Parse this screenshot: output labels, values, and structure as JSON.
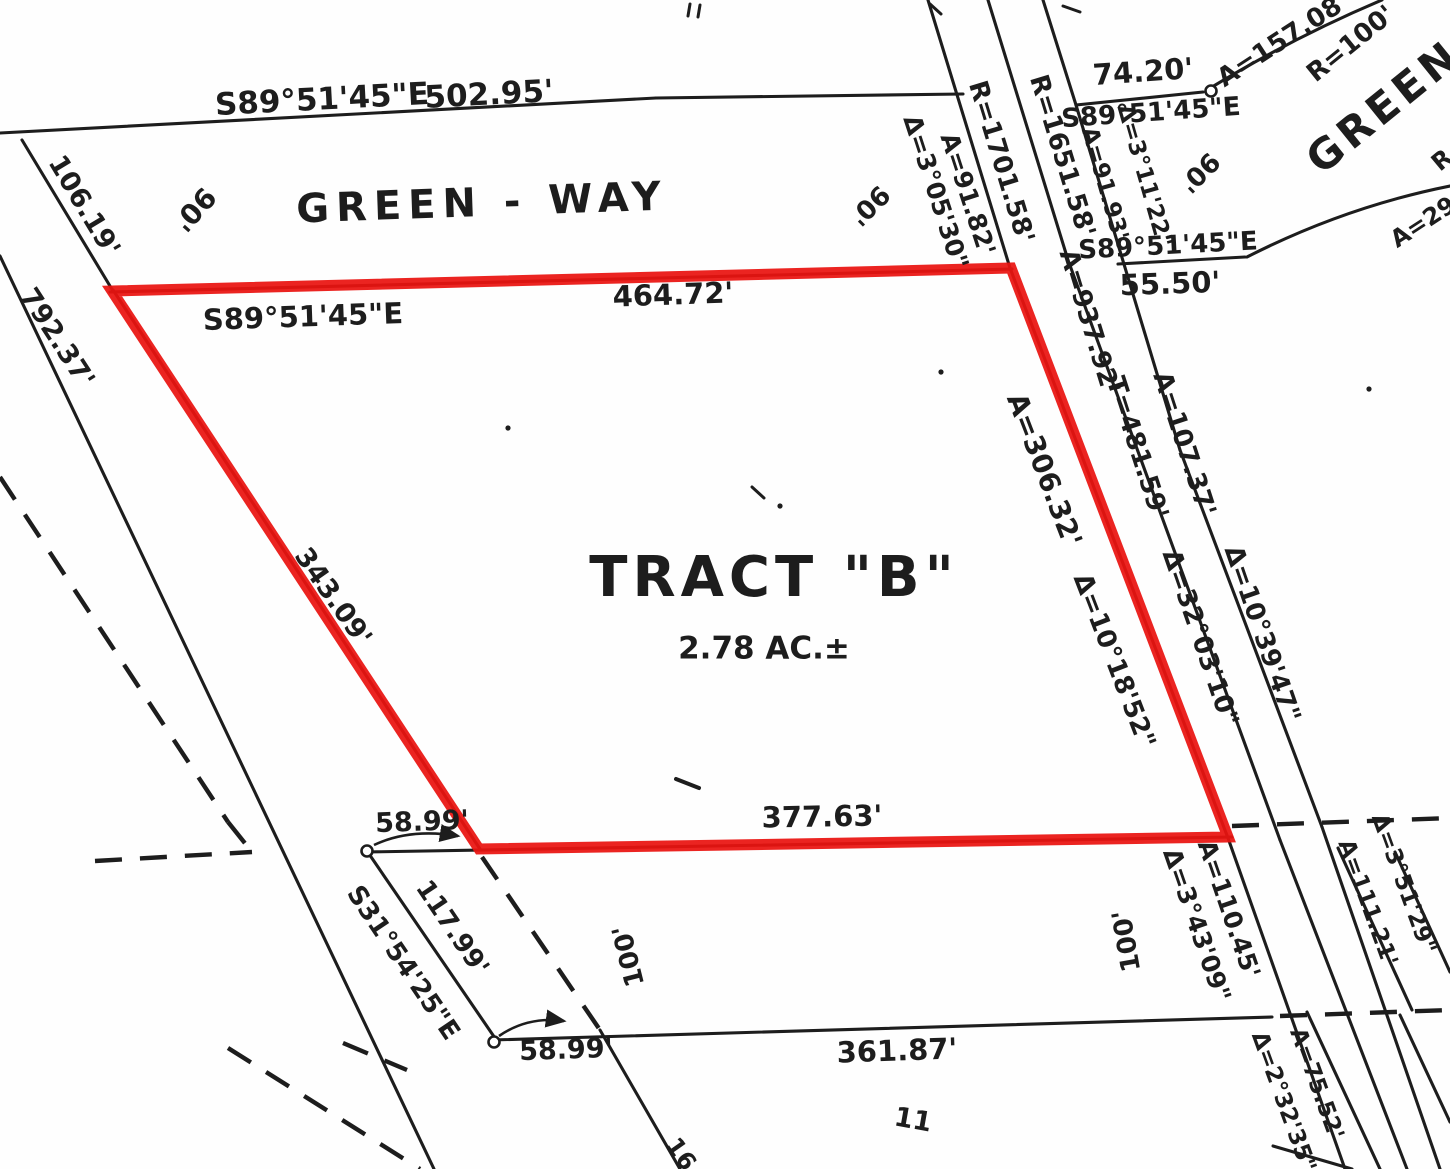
{
  "document": {
    "type": "survey plat map (scanned)",
    "tract_name": "TRACT \"B\"",
    "tract_area": "2.78 AC.±",
    "road_name": "GREEN - WAY"
  },
  "colors": {
    "ink": "#1d1d1d",
    "highlight": "#ea1310",
    "paper": "#fefefe"
  },
  "labels": [
    {
      "id": "bearing-top",
      "t": "S89°51'45\"E",
      "x": 322,
      "y": 100,
      "r": -3,
      "s": 31
    },
    {
      "id": "dist-top",
      "t": "502.95'",
      "x": 489,
      "y": 95,
      "r": -3,
      "s": 31
    },
    {
      "id": "road-name-top",
      "t": "GREEN - WAY",
      "x": 482,
      "y": 203,
      "r": -2,
      "s": 40,
      "ls": 7
    },
    {
      "id": "width-90-a",
      "t": "90'",
      "x": 194,
      "y": 209,
      "r": 132,
      "s": 28
    },
    {
      "id": "dist-106",
      "t": "106.19'",
      "x": 84,
      "y": 206,
      "r": 59,
      "s": 27
    },
    {
      "id": "dist-792",
      "t": "792.37'",
      "x": 57,
      "y": 338,
      "r": 57,
      "s": 27
    },
    {
      "id": "bearing-parcel-top",
      "t": "S89°51'45\"E",
      "x": 303,
      "y": 317,
      "r": -2,
      "s": 29
    },
    {
      "id": "dist-parcel-top",
      "t": "464.72'",
      "x": 673,
      "y": 295,
      "r": -2,
      "s": 29
    },
    {
      "id": "dist-343",
      "t": "343.09'",
      "x": 333,
      "y": 597,
      "r": 55,
      "s": 27
    },
    {
      "id": "tract-name",
      "t": "TRACT \"B\"",
      "x": 774,
      "y": 578,
      "r": 0,
      "s": 56,
      "ls": 5
    },
    {
      "id": "tract-area",
      "t": "2.78 AC.±",
      "x": 764,
      "y": 649,
      "r": 0,
      "s": 31
    },
    {
      "id": "dist-377",
      "t": "377.63'",
      "x": 822,
      "y": 817,
      "r": -1,
      "s": 29
    },
    {
      "id": "dist-5899-a",
      "t": "58.99'",
      "x": 422,
      "y": 822,
      "r": -2,
      "s": 27
    },
    {
      "id": "bearing-s31",
      "t": "S31°54'25\"E",
      "x": 403,
      "y": 963,
      "r": 56,
      "s": 26
    },
    {
      "id": "dist-117",
      "t": "117.99'",
      "x": 452,
      "y": 928,
      "r": 56,
      "s": 26
    },
    {
      "id": "dist-5899-b",
      "t": "58.99'",
      "x": 566,
      "y": 1050,
      "r": -2,
      "s": 27
    },
    {
      "id": "dist-361",
      "t": "361.87'",
      "x": 897,
      "y": 1051,
      "r": -2,
      "s": 29
    },
    {
      "id": "lot-11",
      "t": "11",
      "x": 913,
      "y": 1120,
      "r": 10,
      "s": 27
    },
    {
      "id": "width-100-a",
      "t": "100'",
      "x": 629,
      "y": 956,
      "r": -104,
      "s": 26
    },
    {
      "id": "width-100-b",
      "t": "100'",
      "x": 1127,
      "y": 941,
      "r": -100,
      "s": 26
    },
    {
      "id": "r-1701",
      "t": "R=1701.58'",
      "x": 1001,
      "y": 162,
      "r": 73,
      "s": 26
    },
    {
      "id": "r-1651",
      "t": "R=1651.58'",
      "x": 1062,
      "y": 156,
      "r": 73,
      "s": 26
    },
    {
      "id": "a-9182",
      "t": "A=91.82'",
      "x": 968,
      "y": 194,
      "r": 72,
      "s": 25
    },
    {
      "id": "d-30530",
      "t": "Δ=3°05'30\"",
      "x": 936,
      "y": 192,
      "r": 72,
      "s": 25
    },
    {
      "id": "dist-7420",
      "t": "74.20'",
      "x": 1143,
      "y": 72,
      "r": -4,
      "s": 29
    },
    {
      "id": "bearing-ne1",
      "t": "S89°51'45\"E",
      "x": 1151,
      "y": 113,
      "r": -4,
      "s": 26
    },
    {
      "id": "d-31122",
      "t": "Δ=3°11'22\"",
      "x": 1144,
      "y": 176,
      "r": 74,
      "s": 23
    },
    {
      "id": "a-9193",
      "t": "A=91.93'",
      "x": 1104,
      "y": 184,
      "r": 74,
      "s": 23
    },
    {
      "id": "width-90-b",
      "t": "90'",
      "x": 869,
      "y": 205,
      "r": 135,
      "s": 26
    },
    {
      "id": "width-90-c",
      "t": "90'",
      "x": 1199,
      "y": 172,
      "r": 135,
      "s": 26
    },
    {
      "id": "bearing-ne2",
      "t": "S89°51'45\"E",
      "x": 1168,
      "y": 246,
      "r": -3,
      "s": 26
    },
    {
      "id": "dist-5550",
      "t": "55.50'",
      "x": 1170,
      "y": 284,
      "r": -2,
      "s": 29
    },
    {
      "id": "a-15708",
      "t": "A=157.08'",
      "x": 1283,
      "y": 40,
      "r": -33,
      "s": 26
    },
    {
      "id": "r-100",
      "t": "R=100'",
      "x": 1351,
      "y": 44,
      "r": -39,
      "s": 26
    },
    {
      "id": "road-name-curve",
      "t": "GREEN",
      "x": 1384,
      "y": 107,
      "r": -39,
      "s": 42,
      "ls": 5
    },
    {
      "id": "a-29-partial",
      "t": "A=29",
      "x": 1423,
      "y": 222,
      "r": -33,
      "s": 24
    },
    {
      "id": "r-partial",
      "t": "R",
      "x": 1442,
      "y": 160,
      "r": -40,
      "s": 24
    },
    {
      "id": "a-93792",
      "t": "A=937.92'",
      "x": 1089,
      "y": 322,
      "r": 73,
      "s": 26
    },
    {
      "id": "t-48159",
      "t": "T=481.59'",
      "x": 1137,
      "y": 448,
      "r": 72,
      "s": 26
    },
    {
      "id": "a-10737",
      "t": "A=107.37'",
      "x": 1184,
      "y": 444,
      "r": 72,
      "s": 26
    },
    {
      "id": "d-320310",
      "t": "Δ=32°03'10\"",
      "x": 1200,
      "y": 638,
      "r": 71,
      "s": 26
    },
    {
      "id": "d-103947",
      "t": "Δ=10°39'47\"",
      "x": 1262,
      "y": 634,
      "r": 71,
      "s": 26
    },
    {
      "id": "a-30632",
      "t": "A=306.32'",
      "x": 1044,
      "y": 470,
      "r": 69,
      "s": 28
    },
    {
      "id": "d-101852",
      "t": "Δ=10°18'52\"",
      "x": 1114,
      "y": 661,
      "r": 69,
      "s": 26
    },
    {
      "id": "a-11045",
      "t": "A=110.45'",
      "x": 1229,
      "y": 909,
      "r": 71,
      "s": 25
    },
    {
      "id": "d-34309",
      "t": "Δ=3°43'09\"",
      "x": 1197,
      "y": 925,
      "r": 71,
      "s": 25
    },
    {
      "id": "d-35129",
      "t": "Δ=3°51'29\"",
      "x": 1403,
      "y": 884,
      "r": 70,
      "s": 23
    },
    {
      "id": "a-11121",
      "t": "A=111.21'",
      "x": 1367,
      "y": 903,
      "r": 70,
      "s": 23
    },
    {
      "id": "a-7552",
      "t": "A=75.52'",
      "x": 1316,
      "y": 1084,
      "r": 70,
      "s": 23
    },
    {
      "id": "d-23235",
      "t": "Δ=2°32'35\"",
      "x": 1283,
      "y": 1102,
      "r": 70,
      "s": 23
    },
    {
      "id": "lot-16-partial",
      "t": "16",
      "x": 681,
      "y": 1154,
      "r": 55,
      "s": 24
    }
  ],
  "geometry": {
    "red_parcel_points": "112,291 1011,268 1228,837 479,849",
    "solid_lines": [
      [
        0,
        133,
        656,
        98
      ],
      [
        656,
        98,
        963,
        94
      ],
      [
        22,
        140,
        113,
        291
      ],
      [
        0,
        256,
        434,
        1169
      ],
      [
        110,
        292,
        1012,
        269
      ],
      [
        113,
        290,
        480,
        849
      ],
      [
        366,
        852,
        1232,
        837
      ],
      [
        1010,
        268,
        1228,
        838
      ],
      [
        928,
        0,
        1010,
        268
      ],
      [
        1228,
        838,
        1345,
        1169
      ],
      [
        988,
        0,
        1068,
        260
      ],
      [
        1068,
        260,
        1280,
        840
      ],
      [
        1280,
        840,
        1407,
        1169
      ],
      [
        1043,
        0,
        1076,
        105
      ],
      [
        1076,
        105,
        1180,
        450
      ],
      [
        1180,
        450,
        1322,
        827
      ],
      [
        1322,
        827,
        1440,
        1169
      ],
      [
        1076,
        105,
        1203,
        92
      ],
      [
        1118,
        264,
        1245,
        257
      ],
      [
        492,
        1040,
        1272,
        1017
      ],
      [
        367,
        851,
        497,
        1041
      ],
      [
        600,
        1030,
        680,
        1169
      ],
      [
        1338,
        848,
        1412,
        1010
      ],
      [
        1395,
        852,
        1450,
        972
      ],
      [
        1307,
        1012,
        1380,
        1169
      ],
      [
        1400,
        1015,
        1450,
        1122
      ],
      [
        1273,
        1146,
        1352,
        1169
      ]
    ],
    "curve_paths": [
      "M1207,90 Q1292,38 1382,0",
      "M1247,257 Q1345,207 1450,186"
    ],
    "dashed_lines": [
      [
        0,
        477,
        228,
        822
      ],
      [
        228,
        822,
        252,
        852
      ],
      [
        95,
        861,
        252,
        852
      ],
      [
        228,
        1048,
        420,
        1169
      ],
      [
        343,
        1043,
        407,
        1070
      ],
      [
        482,
        857,
        600,
        1030
      ],
      [
        1232,
        826,
        1450,
        818
      ],
      [
        1280,
        1016,
        1450,
        1010
      ]
    ],
    "survey_point_circles": [
      [
        1211,
        91
      ],
      [
        367,
        851
      ],
      [
        494,
        1042
      ]
    ],
    "leader_arrows": [
      "M374,845 Q410,828 458,836",
      "M499,1036 Q528,1016 564,1021"
    ],
    "artifact_ticks": [
      [
        690,
        4,
        688,
        16,
        3
      ],
      [
        700,
        5,
        698,
        17,
        3
      ],
      [
        930,
        4,
        941,
        14,
        3
      ],
      [
        1063,
        6,
        1080,
        12,
        3
      ],
      [
        676,
        779,
        699,
        788,
        4
      ],
      [
        752,
        487,
        764,
        498,
        3
      ]
    ],
    "artifact_dots": [
      [
        780,
        506
      ],
      [
        941,
        372
      ],
      [
        1369,
        389
      ],
      [
        508,
        428
      ]
    ]
  }
}
